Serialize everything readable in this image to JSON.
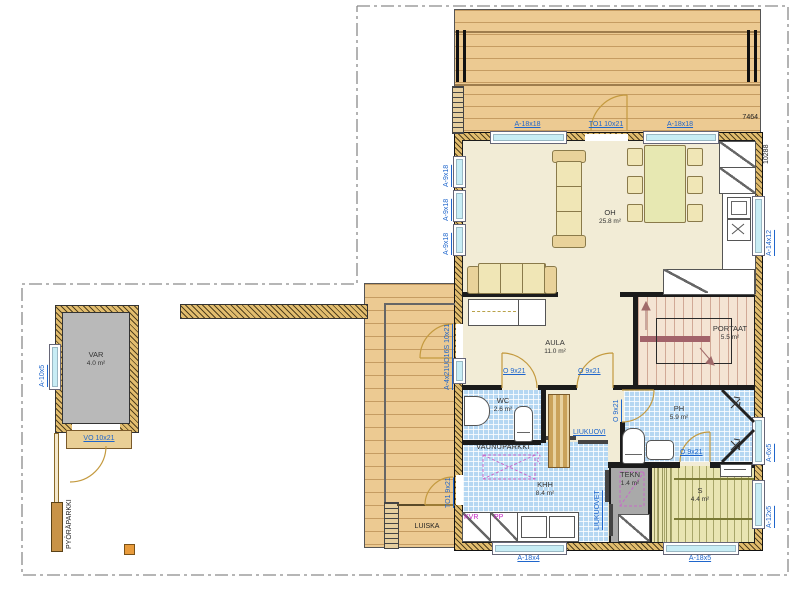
{
  "rooms": {
    "oh": {
      "name": "OH",
      "area": "25.8 m²"
    },
    "aula": {
      "name": "AULA",
      "area": "11.0 m²"
    },
    "portaat": {
      "name": "PORTAAT",
      "area": "5.5 m²"
    },
    "wc": {
      "name": "WC",
      "area": "2.6 m²"
    },
    "ph": {
      "name": "PH",
      "area": "5.9 m²"
    },
    "tekn": {
      "name": "TEKN",
      "area": "1.4 m²"
    },
    "khh": {
      "name": "KHH",
      "area": "8.4 m²"
    },
    "sauna": {
      "name": "S",
      "area": "4.4 m²"
    },
    "var": {
      "name": "VAR",
      "area": "4.0 m²"
    }
  },
  "openings": {
    "top_window_left": "A-18x18",
    "top_terrace_door": "TO1 10x21",
    "top_window_right": "A-18x18",
    "left_window_a": "A-9x18",
    "left_window_b": "A-9x18",
    "left_window_c": "A-9x18",
    "entry_door": "A-4x21UO16S 10x21",
    "left_lower_door": "TO1 9x21",
    "right_window_kitchen": "A-14x12",
    "right_window_ph": "A-6x5",
    "right_window_sauna": "A-12x5",
    "bottom_window_khh": "A-18x4",
    "bottom_window_sauna": "A-18x5",
    "door_std": "O 9x21",
    "sliding_door": "LIUKUOVI",
    "sliding_doors": "LIUKUOVET",
    "var_door": "VO 10x21",
    "var_window": "A-10x5"
  },
  "annotations": {
    "stroller": "VAUNUPARKKI",
    "bike": "PYÖRÄPARKKI",
    "ramp": "LUISKA",
    "dryer": "KVR",
    "washer": "PP"
  },
  "dimensions": {
    "width": "7464",
    "depth": "10288"
  }
}
